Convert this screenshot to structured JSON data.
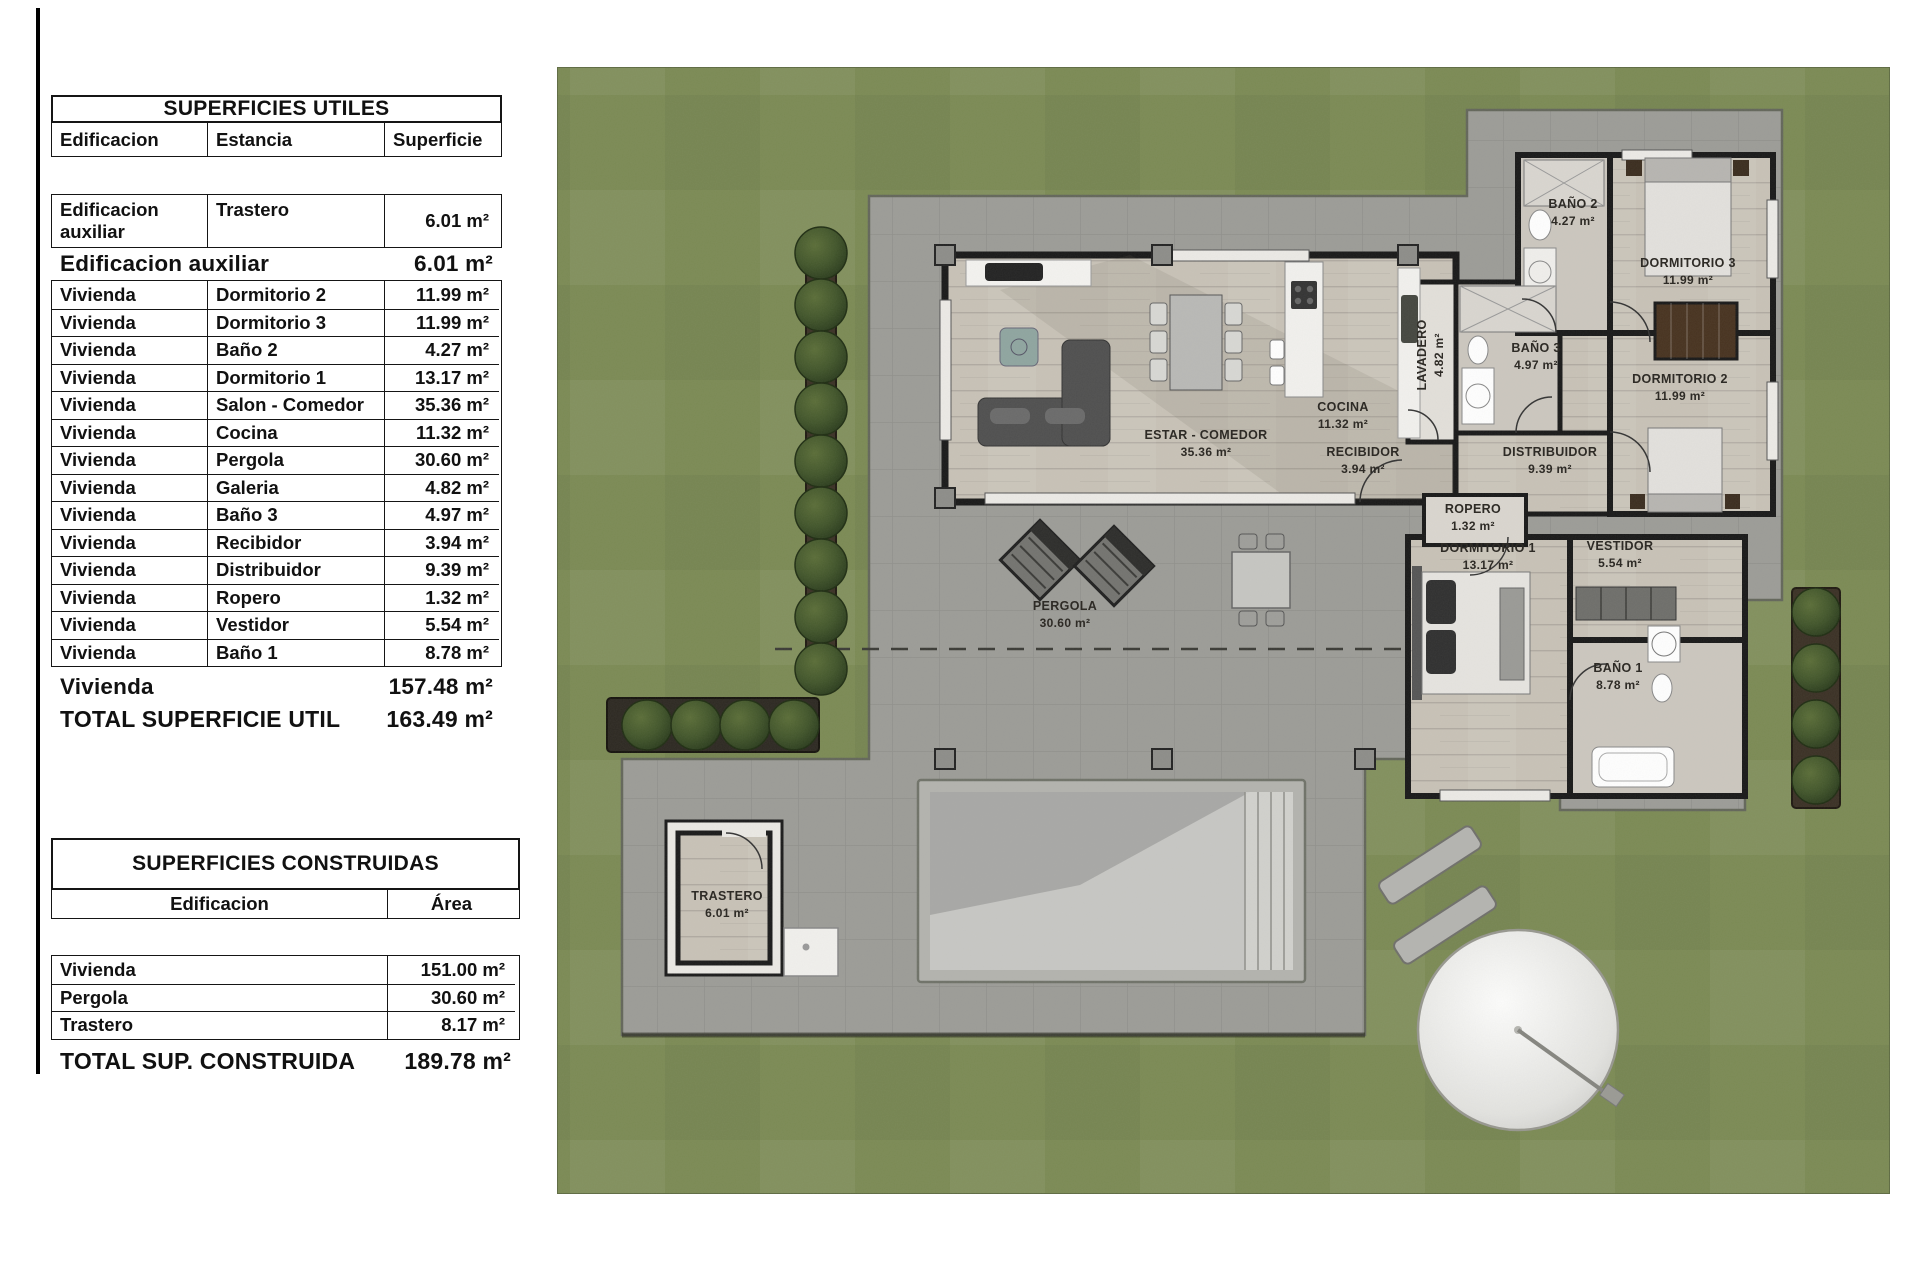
{
  "colors": {
    "grass": "#7b8a54",
    "terrace": "#9c9c97",
    "wood_floor": "#c8c2b7",
    "wall": "#181818",
    "pool_water": "#c7c7c4",
    "tree": "#3f522a",
    "label_text": "#2e2b26"
  },
  "tables": {
    "utiles": {
      "title": "SUPERFICIES UTILES",
      "columns": [
        "Edificacion",
        "Estancia",
        "Superficie"
      ],
      "aux_row": {
        "edificacion": "Edificacion auxiliar",
        "estancia": "Trastero",
        "superficie": "6.01 m²"
      },
      "aux_subtotal": {
        "label": "Edificacion auxiliar",
        "value": "6.01 m²"
      },
      "rows": [
        {
          "edificacion": "Vivienda",
          "estancia": "Dormitorio 2",
          "superficie": "11.99 m²"
        },
        {
          "edificacion": "Vivienda",
          "estancia": "Dormitorio 3",
          "superficie": "11.99 m²"
        },
        {
          "edificacion": "Vivienda",
          "estancia": "Baño 2",
          "superficie": "4.27 m²"
        },
        {
          "edificacion": "Vivienda",
          "estancia": "Dormitorio 1",
          "superficie": "13.17 m²"
        },
        {
          "edificacion": "Vivienda",
          "estancia": "Salon - Comedor",
          "superficie": "35.36 m²"
        },
        {
          "edificacion": "Vivienda",
          "estancia": "Cocina",
          "superficie": "11.32 m²"
        },
        {
          "edificacion": "Vivienda",
          "estancia": "Pergola",
          "superficie": "30.60 m²"
        },
        {
          "edificacion": "Vivienda",
          "estancia": "Galeria",
          "superficie": "4.82 m²"
        },
        {
          "edificacion": "Vivienda",
          "estancia": "Baño 3",
          "superficie": "4.97 m²"
        },
        {
          "edificacion": "Vivienda",
          "estancia": "Recibidor",
          "superficie": "3.94 m²"
        },
        {
          "edificacion": "Vivienda",
          "estancia": "Distribuidor",
          "superficie": "9.39 m²"
        },
        {
          "edificacion": "Vivienda",
          "estancia": "Ropero",
          "superficie": "1.32 m²"
        },
        {
          "edificacion": "Vivienda",
          "estancia": "Vestidor",
          "superficie": "5.54 m²"
        },
        {
          "edificacion": "Vivienda",
          "estancia": "Baño 1",
          "superficie": "8.78 m²"
        }
      ],
      "vivienda_subtotal": {
        "label": "Vivienda",
        "value": "157.48 m²"
      },
      "total": {
        "label": "TOTAL SUPERFICIE UTIL",
        "value": "163.49 m²"
      }
    },
    "construidas": {
      "title": "SUPERFICIES CONSTRUIDAS",
      "columns": [
        "Edificacion",
        "Área"
      ],
      "rows": [
        {
          "edificacion": "Vivienda",
          "area": "151.00 m²"
        },
        {
          "edificacion": "Pergola",
          "area": "30.60 m²"
        },
        {
          "edificacion": "Trastero",
          "area": "8.17 m²"
        }
      ],
      "total": {
        "label": "TOTAL SUP. CONSTRUIDA",
        "value": "189.78 m²"
      }
    }
  },
  "plan": {
    "rooms": {
      "estar": {
        "name": "ESTAR - COMEDOR",
        "area": "35.36 m²"
      },
      "cocina": {
        "name": "COCINA",
        "area": "11.32 m²"
      },
      "recibidor": {
        "name": "RECIBIDOR",
        "area": "3.94 m²"
      },
      "lavadero": {
        "name": "LAVADERO",
        "area": "4.82 m²"
      },
      "bano3": {
        "name": "BAÑO 3",
        "area": "4.97 m²"
      },
      "bano2": {
        "name": "BAÑO 2",
        "area": "4.27 m²"
      },
      "dorm3": {
        "name": "DORMITORIO 3",
        "area": "11.99 m²"
      },
      "dorm2": {
        "name": "DORMITORIO 2",
        "area": "11.99 m²"
      },
      "distribuidor": {
        "name": "DISTRIBUIDOR",
        "area": "9.39 m²"
      },
      "ropero": {
        "name": "ROPERO",
        "area": "1.32 m²"
      },
      "dorm1": {
        "name": "DORMITORIO 1",
        "area": "13.17 m²"
      },
      "vestidor": {
        "name": "VESTIDOR",
        "area": "5.54 m²"
      },
      "bano1": {
        "name": "BAÑO 1",
        "area": "8.78 m²"
      },
      "pergola": {
        "name": "PERGOLA",
        "area": "30.60 m²"
      },
      "trastero": {
        "name": "TRASTERO",
        "area": "6.01 m²"
      }
    }
  }
}
